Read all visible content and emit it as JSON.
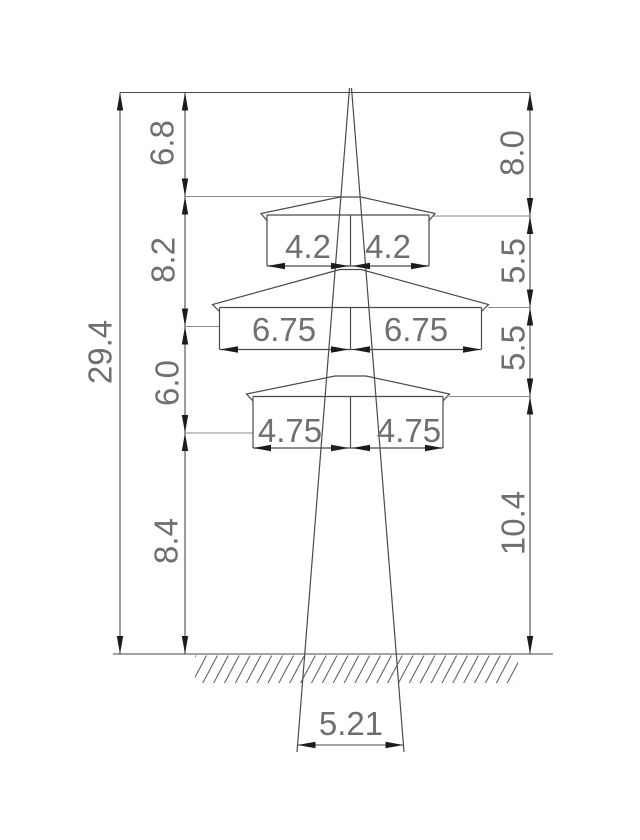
{
  "drawing": {
    "kind": "transmission-tower-elevation-dimension-drawing",
    "units_shown": "none",
    "overall_height": "29.4",
    "left_segments": {
      "s1": "6.8",
      "s2": "8.2",
      "s3": "6.0",
      "s4": "8.4"
    },
    "right_segments": {
      "s1": "8.0",
      "s2": "5.5",
      "s3": "5.5",
      "s4": "10.4"
    },
    "crossarms": {
      "top": {
        "left": "4.2",
        "right": "4.2"
      },
      "middle": {
        "left": "6.75",
        "right": "6.75"
      },
      "bottom": {
        "left": "4.75",
        "right": "4.75"
      }
    },
    "base_width": "5.21"
  }
}
